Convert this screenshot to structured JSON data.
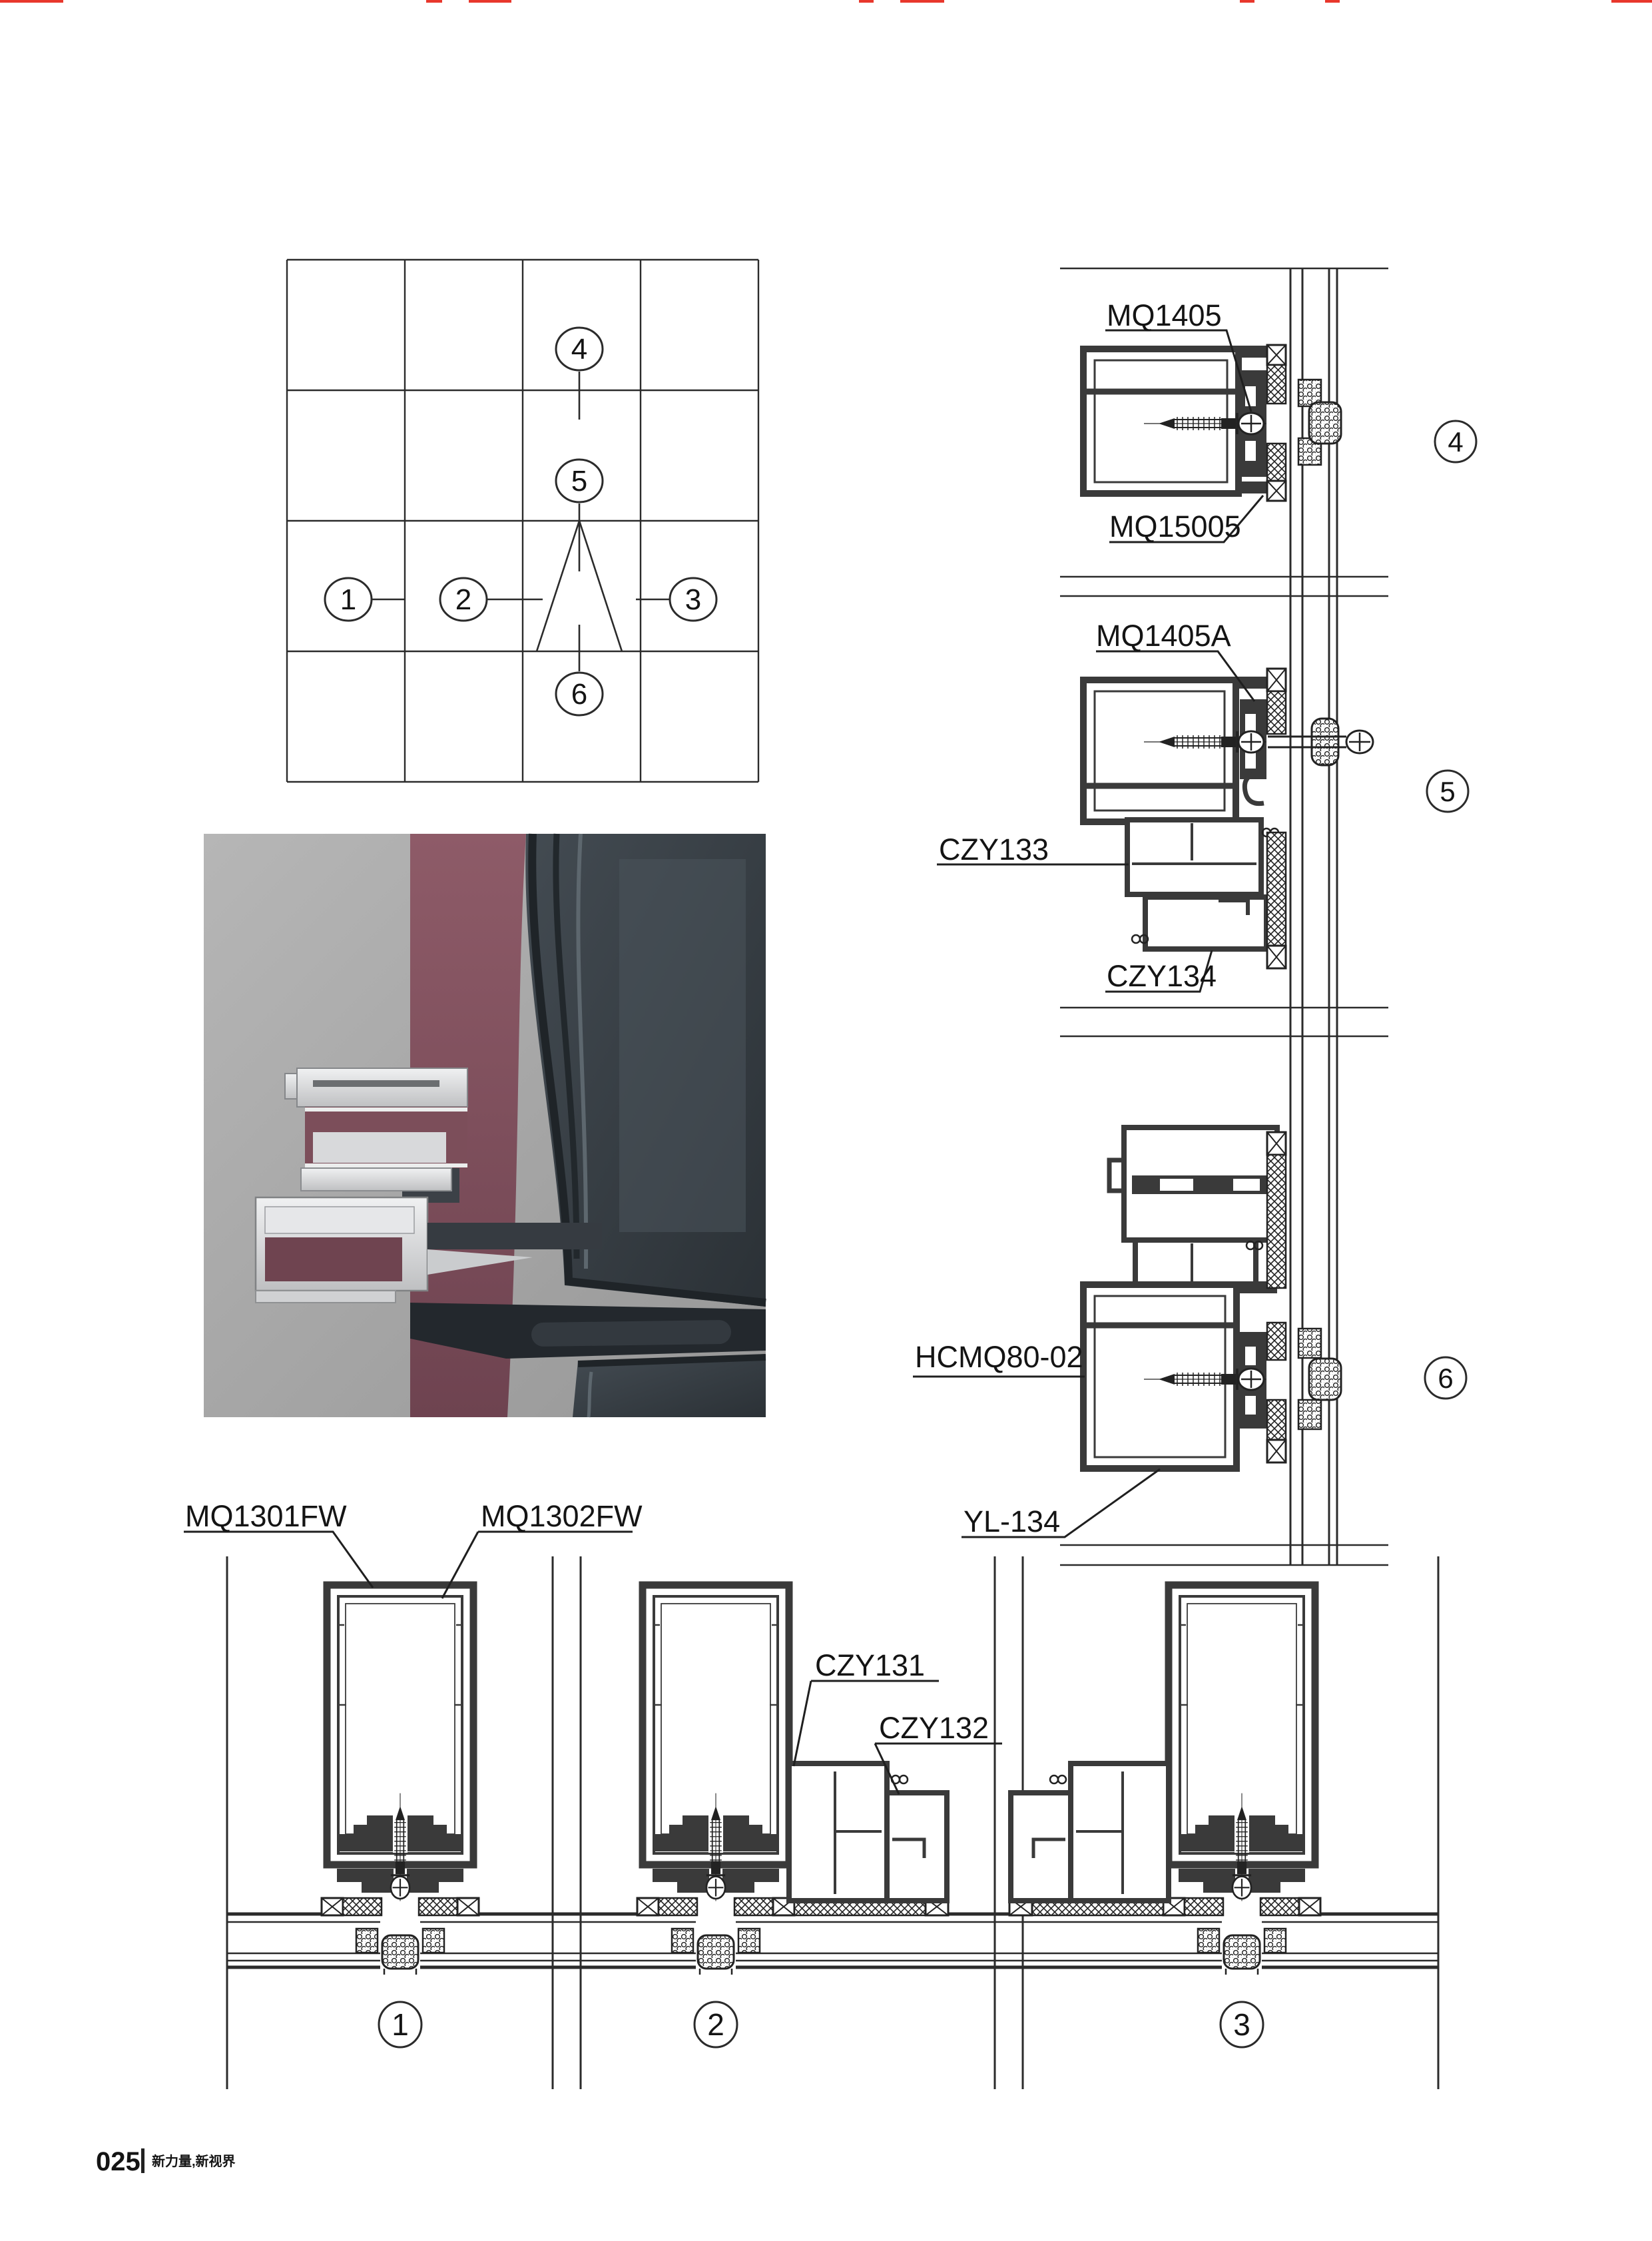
{
  "page": {
    "background": "#ffffff",
    "footer": {
      "page_number": "025",
      "slogan": "新力量,新视界"
    }
  },
  "accents": {
    "crop_mark_red": "#e8372c",
    "drawing_line": "#2b2b2b",
    "profile_dark_fill": "#3a3a3a"
  },
  "render": {
    "background_gray": "#a9a9a9",
    "panel_maroon": "#82505c",
    "glass_dark": "#343b41",
    "aluminum_silver": "#dcdddf"
  },
  "key_plan": {
    "c1": "1",
    "c2": "2",
    "c3": "3",
    "c4": "4",
    "c5": "5",
    "c6": "6"
  },
  "detail_1": {
    "callout": "1",
    "label_left": "MQ1301FW",
    "label_right": "MQ1302FW"
  },
  "detail_2": {
    "callout": "2",
    "label_upper": "CZY131",
    "label_lower": "CZY132"
  },
  "detail_3": {
    "callout": "3"
  },
  "detail_4": {
    "callout": "4",
    "label_top": "MQ1405",
    "label_bottom": "MQ15005"
  },
  "detail_5": {
    "callout": "5",
    "label_top": "MQ1405A",
    "label_left": "CZY133",
    "label_bottom": "CZY134"
  },
  "detail_6": {
    "callout": "6",
    "label_left": "HCMQ80-02",
    "label_bottom": "YL-134"
  }
}
